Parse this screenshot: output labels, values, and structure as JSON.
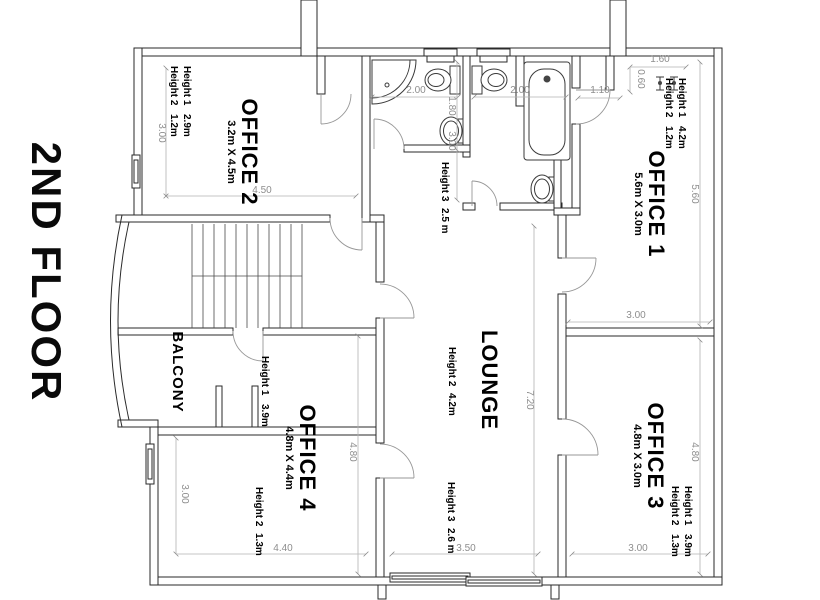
{
  "title": "2ND FLOOR",
  "rooms": {
    "office1": {
      "name": "OFFICE 1",
      "size": "5.6m X 3.0m",
      "h1_label": "Height 1",
      "h1_value": "4.2m",
      "h2_label": "Height 2",
      "h2_value": "1.2m"
    },
    "office2": {
      "name": "OFFICE 2",
      "size": "3.2m X 4.5m",
      "h1_label": "Height 1",
      "h1_value": "2.9m",
      "h2_label": "Height 2",
      "h2_value": "1.2m"
    },
    "office3": {
      "name": "OFFICE 3",
      "size": "4.8m X 3.0m",
      "h1_label": "Height 1",
      "h1_value": "3.9m",
      "h2_label": "Height 2",
      "h2_value": "1.3m"
    },
    "office4": {
      "name": "OFFICE 4",
      "size": "4.8m X 4.4m",
      "h2_label": "Height 2",
      "h2_value": "1.3m"
    },
    "lounge": {
      "name": "LOUNGE",
      "h2_label": "Height 2",
      "h2_value": "4.2m"
    },
    "balcony": {
      "name": "BALCONY",
      "h1_label": "Height 1",
      "h1_value": "3.9m"
    },
    "hallway": {
      "h3_label": "Height 3",
      "h3_value": "2.5 m"
    },
    "store": {
      "h3_label": "Height 3",
      "h3_value": "2.6 m"
    }
  },
  "dims": {
    "office2_side": "3.00",
    "office2_width": "4.50",
    "bath_left": "2.00",
    "bath_right": "2.00",
    "bath_inner": "1.80",
    "bath_depth": "3.00",
    "office1_door": "1.10",
    "nook_width": "1.60",
    "nook_depth": "0.60",
    "office1_length": "5.60",
    "office1_width": "3.00",
    "lounge_length": "7.20",
    "lounge_side": "4.80",
    "office4_side": "3.00",
    "office4_width": "4.40",
    "store_width": "3.50",
    "office3_width": "3.00",
    "office3_length": "4.80"
  }
}
